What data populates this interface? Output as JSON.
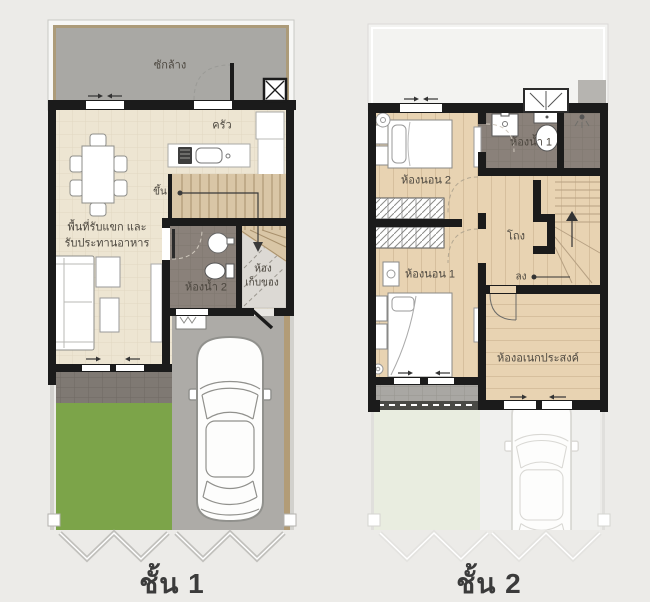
{
  "page": {
    "background": "#ecebe8"
  },
  "floor1": {
    "title": "ชั้น 1",
    "labels": {
      "laundry": "ซักล้าง",
      "kitchen": "ครัว",
      "stairs_up": "ขึ้น",
      "living_dining_line1": "พื้นที่รับแขก และ",
      "living_dining_line2": "รับประทานอาหาร",
      "bathroom2": "ห้องน้ำ 2",
      "storage_line1": "ห้อง",
      "storage_line2": "เก็บของ"
    }
  },
  "floor2": {
    "title": "ชั้น 2",
    "labels": {
      "bedroom2": "ห้องนอน 2",
      "bathroom1": "ห้องน้ำ 1",
      "hall": "โถง",
      "stairs_down": "ลง",
      "bedroom1": "ห้องนอน 1",
      "multipurpose": "ห้องอเนกประสงค์"
    }
  },
  "furniture_icons": [
    "dining-table",
    "sofa",
    "coffee-table",
    "car",
    "bed-single",
    "bed-double",
    "toilet",
    "washbasin",
    "shower",
    "kitchen-sink",
    "stove",
    "fridge",
    "fan",
    "wardrobe",
    "stairs",
    "washer"
  ],
  "colors": {
    "background": "#ECEBE8",
    "wall": "#1B1B1B",
    "cream_floor": "#EDE5D2",
    "wood_floor": "#E8D3B2",
    "stair_wood": "#D9C6A6",
    "bath_gray": "#8A817A",
    "laundry_gray": "#A9A8A4",
    "terrace_gray": "#7F7973",
    "lawn_green": "#7CA449",
    "driveway_gray": "#ADABA7",
    "tan_border": "#B29C77",
    "storage_gray": "#DCD9D4",
    "ghost_lawn": "#E9EDE0",
    "ghost_pavement": "#F0F0EE",
    "title_text": "#3B3B3B",
    "label_text": "#4B463E"
  }
}
